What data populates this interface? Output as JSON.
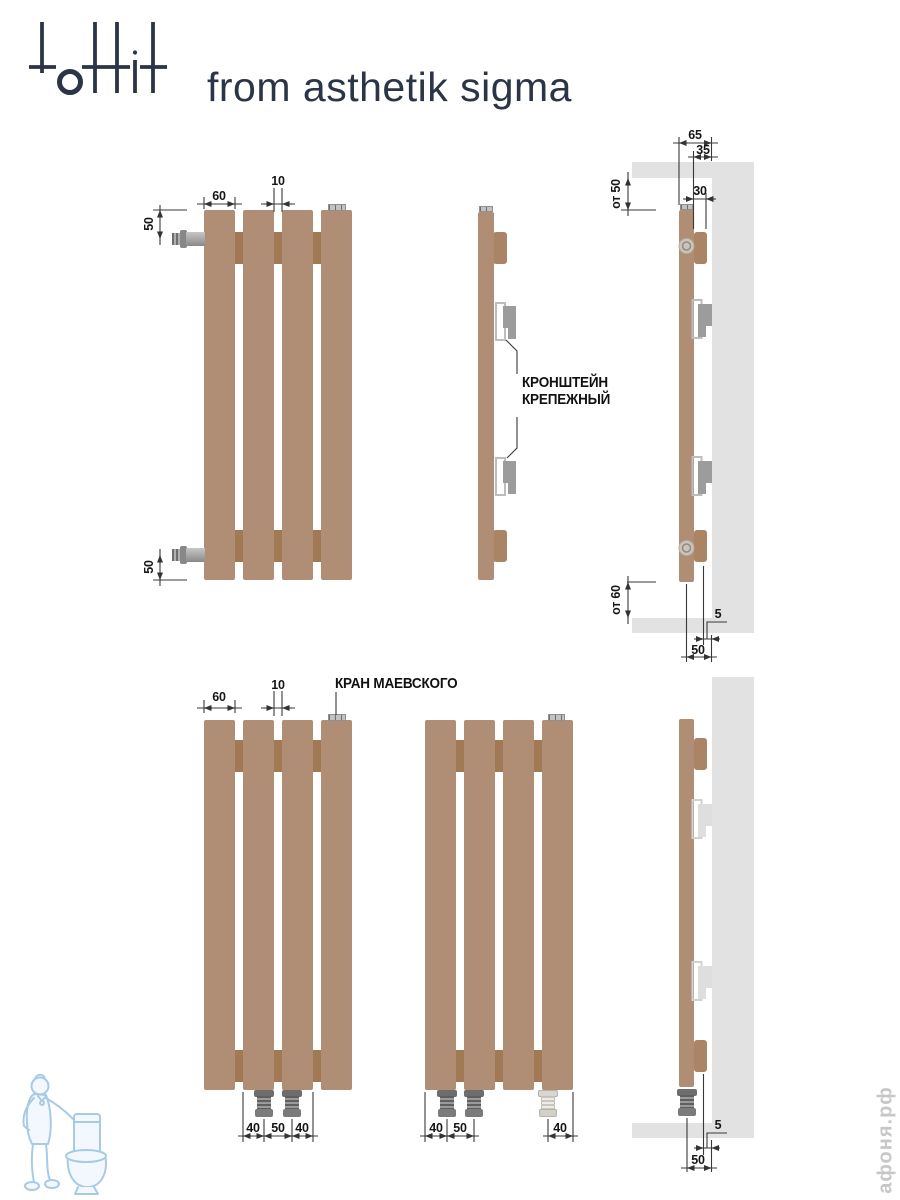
{
  "header": {
    "logo": "tottit",
    "tagline": "from asthetik sigma"
  },
  "callouts": {
    "bracket_line1": "КРОНШТЕЙН",
    "bracket_line2": "КРЕПЕЖНЫЙ",
    "air_valve": "КРАН МАЕВСКОГО"
  },
  "dims": {
    "slat_width": "60",
    "slat_gap": "10",
    "inlet_offset": "50",
    "depth_total": "65",
    "depth_bracket": "35",
    "depth_slat": "30",
    "ceiling_clearance": "от 50",
    "floor_clearance": "от 60",
    "wall_gap": "5",
    "axis_to_wall": "50",
    "conn_side": "40",
    "conn_center": "50"
  },
  "watermark": {
    "site": "афоня.рф"
  },
  "colors": {
    "brand_navy": "#2b3547",
    "radiator_slat": "#af8e75",
    "radiator_connector": "#a17a55",
    "wall_gray": "#e2e2e2",
    "drawing_line": "#383838",
    "watermark_gray": "#c7c7c7",
    "watermark_blue": "#a7cbe5"
  }
}
